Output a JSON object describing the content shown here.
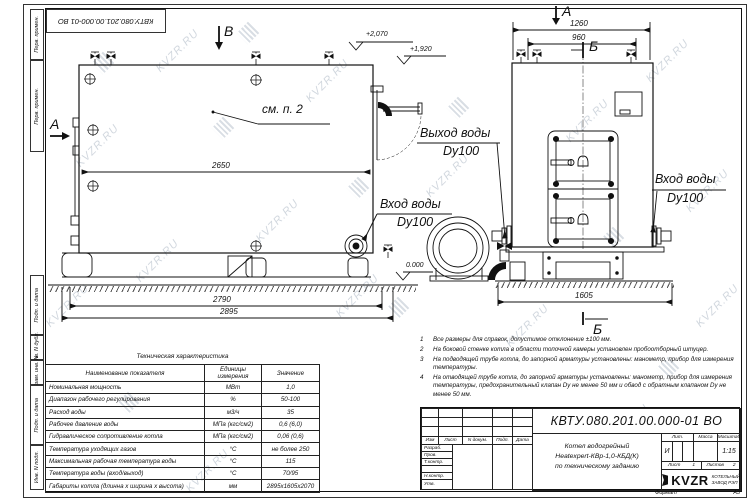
{
  "watermark": {
    "text": "KVZR.RU"
  },
  "stamp_top": {
    "doc_number": "КВТУ.080.201.00.000-01 ВО"
  },
  "sidebar": {
    "items": [
      "Перв. примен.",
      "Перв. примен.",
      "Подп. и дата",
      "Инв. N дубл.",
      "Взам. инв. N",
      "Подп. и дата",
      "Инв. N подл."
    ]
  },
  "views": {
    "side": {
      "section_b": "В",
      "section_a": "А",
      "elev_top": "+2,070",
      "elev_mid": "+1,920",
      "elev_zero": "0.000",
      "dim_inner": "2650",
      "dim_base": "2790",
      "dim_total": "2895",
      "note_ref": "см. п. 2",
      "outlet_line1": "Выход воды",
      "outlet_line2": "Dy100",
      "inlet_line1": "Вход воды",
      "inlet_line2": "Dy100"
    },
    "front": {
      "marker_a": "А",
      "marker_b_top": "Б",
      "marker_b_bottom": "Б",
      "dim_top": "1260",
      "dim_inner": "960",
      "dim_base": "1605",
      "inlet_line1": "Вход воды",
      "inlet_line2": "Dy100"
    }
  },
  "spec_table": {
    "title": "Техническая характеристика",
    "headers": [
      "Наименование показателя",
      "Единицы измерения",
      "Значение"
    ],
    "rows": [
      [
        "Номинальная мощность",
        "МВт",
        "1,0"
      ],
      [
        "Диапазон рабочего регулирования",
        "%",
        "50-100"
      ],
      [
        "Расход воды",
        "м3/ч",
        "35"
      ],
      [
        "Рабочее давление воды",
        "МПа (кгс/см2)",
        "0,6 (6,0)"
      ],
      [
        "Гидравлическое сопротивление котла",
        "МПа (кгс/см2)",
        "0,06 (0,6)"
      ],
      [
        "Температура уходящих газов",
        "°С",
        "не более 250"
      ],
      [
        "Максимальная рабочая температура воды",
        "°С",
        "115"
      ],
      [
        "Температура воды (вход/выход)",
        "°С",
        "70/95"
      ],
      [
        "Габариты котла (длинна х ширина х высота)",
        "мм",
        "2895х1605х2070"
      ]
    ]
  },
  "notes": {
    "items": [
      {
        "n": "1",
        "t": "Все размеры для справок, допустимое отклонение ±100 мм."
      },
      {
        "n": "2",
        "t": "На боковой стенке котла в области топочной камеры установлен пробоотборный штуцер."
      },
      {
        "n": "3",
        "t": "На  подводящей трубе котла, до запорной арматуры установлены: манометр, прибор для измерения температуры."
      },
      {
        "n": "4",
        "t": "На отводящей трубе котла, до запорной арматуры установлены: манометр, прибор для измерения температуры, предохранительный клапан Dу не менее 50 мм и обвод с обратным клапаном Dу не менее 50 мм."
      }
    ]
  },
  "title_block": {
    "doc_number": "КВТУ.080.201.00.000-01 ВО",
    "rev_headers": [
      "Изм",
      "Лист",
      "N докум.",
      "Подп.",
      "Дата"
    ],
    "roles": [
      "Разраб.",
      "Пров.",
      "Т.контр.",
      "",
      "Н.контр.",
      "Утв."
    ],
    "product_line1": "Котел водогрейный",
    "product_line2": "Heatexpert-КВр-1,0-КБД(К)",
    "product_line3": "по техническому заданию",
    "lit_header": "Лит.",
    "mass_header": "Масса",
    "scale_header": "Масштаб",
    "lit_value": "И",
    "scale_value": "1:15",
    "sheet_label": "Лист",
    "sheet_value": "1",
    "sheets_label": "Листов",
    "sheets_value": "2",
    "company_logo": "KVZR",
    "company_name1": "КОТЕЛЬНЫЙ",
    "company_name2": "ЗАВОД РЭП",
    "format_label": "Формат",
    "format_value": "А3"
  }
}
